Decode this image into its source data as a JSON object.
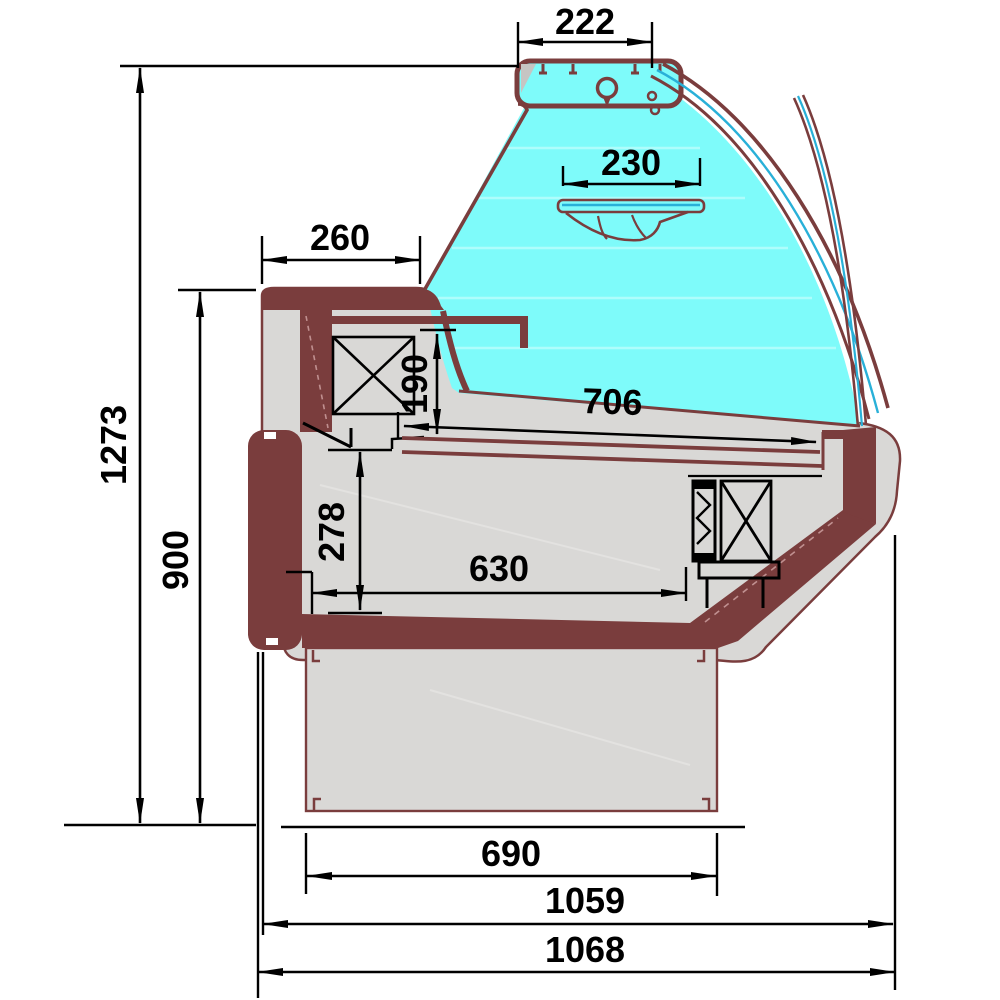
{
  "diagram": {
    "type": "technical-cross-section",
    "subject": "serve-over refrigerated display counter, side section with dimensions",
    "unit": "mm",
    "dimensions": {
      "top_canopy_width": "222",
      "inner_shelf_width": "230",
      "rear_worktop_depth": "260",
      "glass_opening_height": "190",
      "display_deck_depth": "706",
      "under_counter_height": "278",
      "under_counter_depth": "630",
      "overall_height": "1273",
      "worktop_height": "900",
      "plinth_depth": "690",
      "body_depth": "1059",
      "overall_depth": "1068"
    },
    "colors": {
      "profile": "#7a3d3d",
      "body_fill": "#d9d8d6",
      "glass_fill": "#7efbfa",
      "glass_pane_line": "#29b0d8",
      "dimension_lines": "#000000",
      "background": "#ffffff"
    }
  }
}
